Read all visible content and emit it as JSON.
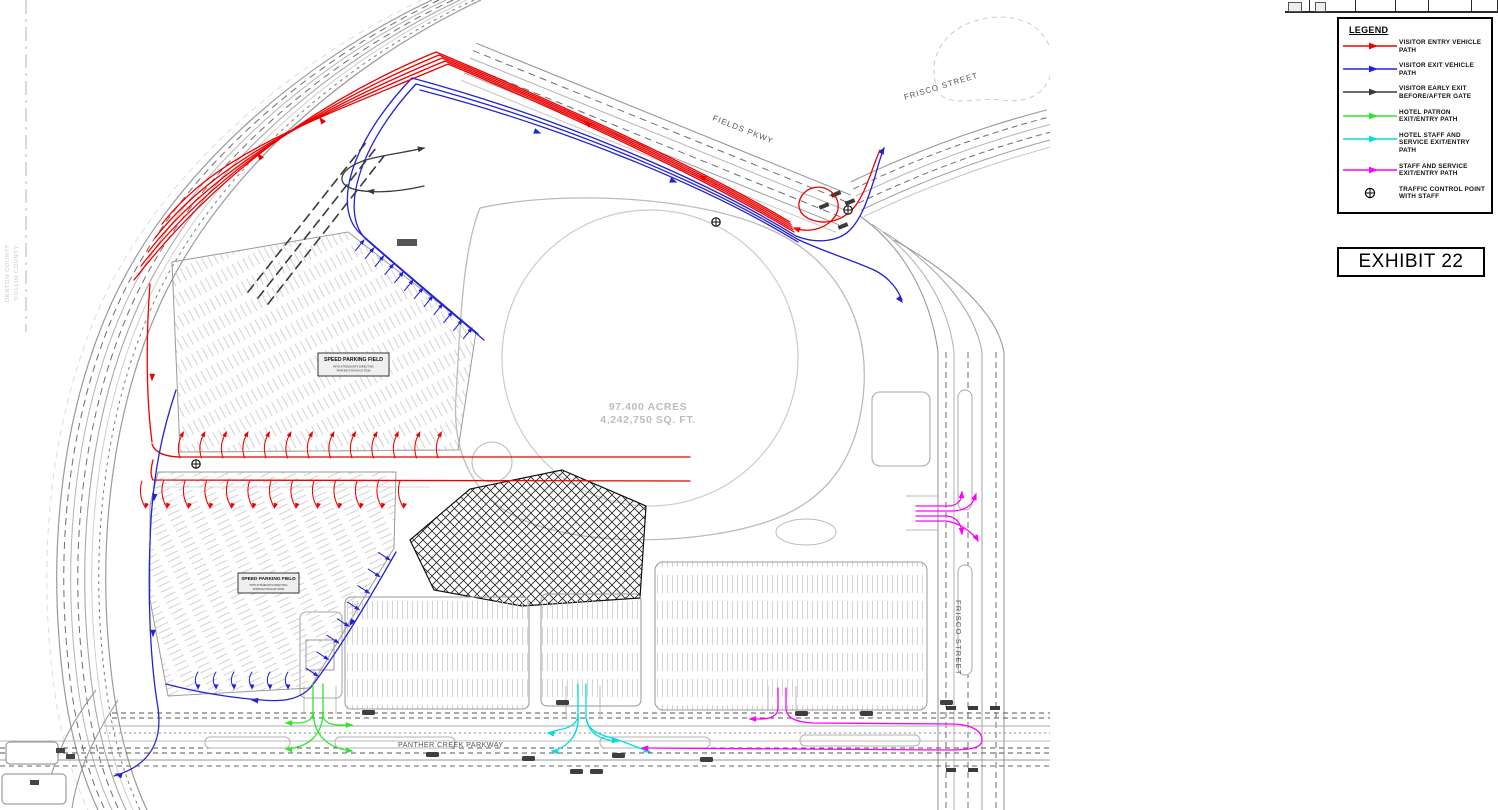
{
  "sheet": {
    "exhibit_label": "EXHIBIT 22",
    "legend": {
      "title": "LEGEND",
      "items": [
        {
          "name": "red",
          "label": "VISITOR ENTRY VEHICLE PATH",
          "color": "#ee0000",
          "style": "arrow"
        },
        {
          "name": "blue",
          "label": "VISITOR EXIT VEHICLE PATH",
          "color": "#2222d8",
          "style": "arrow"
        },
        {
          "name": "black",
          "label": "VISITOR EARLY EXIT BEFORE/AFTER GATE",
          "color": "#3a3a3a",
          "style": "arrow"
        },
        {
          "name": "green",
          "label": "HOTEL PATRON EXIT/ENTRY PATH",
          "color": "#2ee62e",
          "style": "arrow"
        },
        {
          "name": "cyan",
          "label": "HOTEL STAFF AND SERVICE EXIT/ENTRY PATH",
          "color": "#00dede",
          "style": "arrow"
        },
        {
          "name": "magenta",
          "label": "STAFF AND SERVICE EXIT/ENTRY PATH",
          "color": "#ff00ff",
          "style": "arrow"
        },
        {
          "name": "tcp",
          "label": "TRAFFIC CONTROL POINT WITH STAFF",
          "symbol": "⊕",
          "style": "symbol"
        }
      ]
    }
  },
  "map": {
    "site_area_line1": "97.400 ACRES",
    "site_area_line2": "4,242,750 SQ. FT.",
    "road_labels": {
      "frisco_street_north": "FRISCO STREET",
      "fields_parkway": "FIELDS PKWY",
      "frisco_street_south": "FRISCO STREET",
      "panther_creek_parkway": "PANTHER CREEK PARKWAY"
    },
    "county_labels": {
      "west": "DENTON COUNTY",
      "east": "COLLIN COUNTY"
    },
    "parking_field_label": {
      "title": "SPEED PARKING FIELD",
      "note_line1": "WITH ATTENDANTS DIRECTING",
      "note_line2": "PARKING FOR EACH ROW"
    }
  }
}
